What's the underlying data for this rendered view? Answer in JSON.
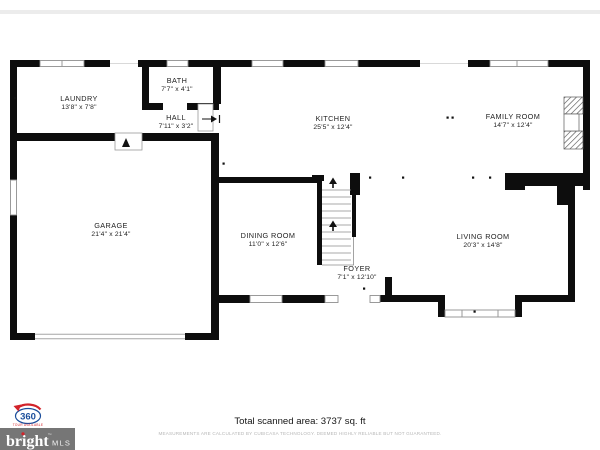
{
  "meta": {
    "background": "#ffffff",
    "top_band_color": "#ececec"
  },
  "floor_plan": {
    "wall_color": "#0d0d0d",
    "rooms": {
      "laundry": {
        "name": "LAUNDRY",
        "dims": "13'8\" x 7'8\""
      },
      "bath": {
        "name": "BATH",
        "dims": "7'7\" x 4'1\""
      },
      "hall": {
        "name": "HALL",
        "dims": "7'11\" x 3'2\""
      },
      "kitchen": {
        "name": "KITCHEN",
        "dims": "25'5\" x 12'4\""
      },
      "family_room": {
        "name": "FAMILY ROOM",
        "dims": "14'7\" x 12'4\""
      },
      "garage": {
        "name": "GARAGE",
        "dims": "21'4\" x 21'4\""
      },
      "dining_room": {
        "name": "DINING ROOM",
        "dims": "11'0\" x 12'6\""
      },
      "foyer": {
        "name": "FOYER",
        "dims": "7'1\" x 12'10\""
      },
      "living_room": {
        "name": "LIVING ROOM",
        "dims": "20'3\" x 14'8\""
      }
    }
  },
  "footer": {
    "total_area": "Total scanned area: 3737 sq. ft",
    "disclaimer": "MEASUREMENTS ARE CALCULATED BY CUBICASA TECHNOLOGY. DEEMED HIGHLY RELIABLE BUT NOT GUARANTEED."
  },
  "badges": {
    "tour_360": {
      "number": "360",
      "label": "TOUR AVAILABLE",
      "arrow_color": "#d2232a",
      "number_color": "#1b4e9b"
    },
    "bright_mls": {
      "brand": "bright",
      "trademark": "™",
      "suffix": "MLS",
      "bg_color": "#767676"
    }
  }
}
